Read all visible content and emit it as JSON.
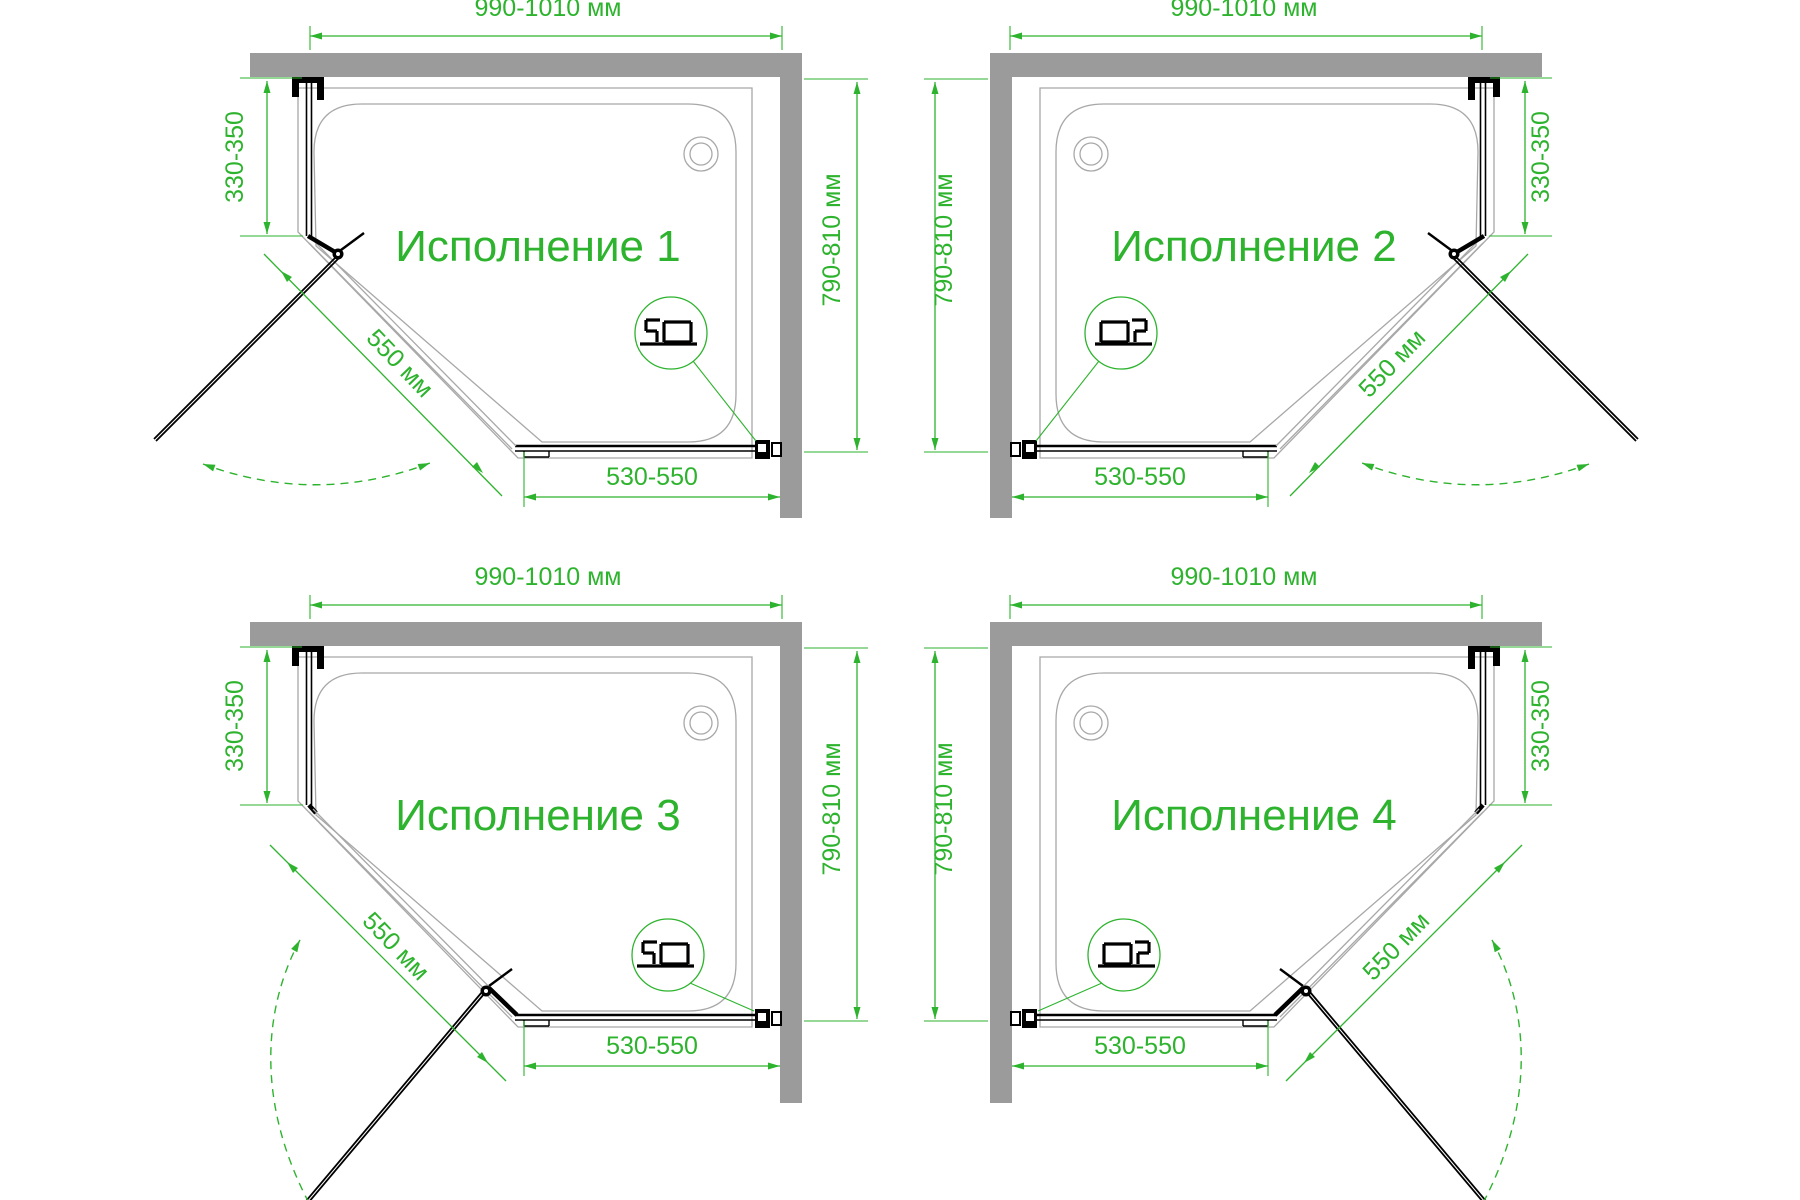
{
  "labels": {
    "width": "990-1010 мм",
    "height": "790-810 мм",
    "side_panel": "330-350",
    "door": "550 мм",
    "bottom_panel": "530-550"
  },
  "diagrams": [
    {
      "title": "Исполнение 1"
    },
    {
      "title": "Исполнение 2"
    },
    {
      "title": "Исполнение 3"
    },
    {
      "title": "Исполнение 4"
    }
  ],
  "colors": {
    "dimension_green": "#2db32d",
    "wall_gray": "#9b9b9b",
    "tray_gray": "#a8a8a8",
    "glass_black": "#000000"
  }
}
